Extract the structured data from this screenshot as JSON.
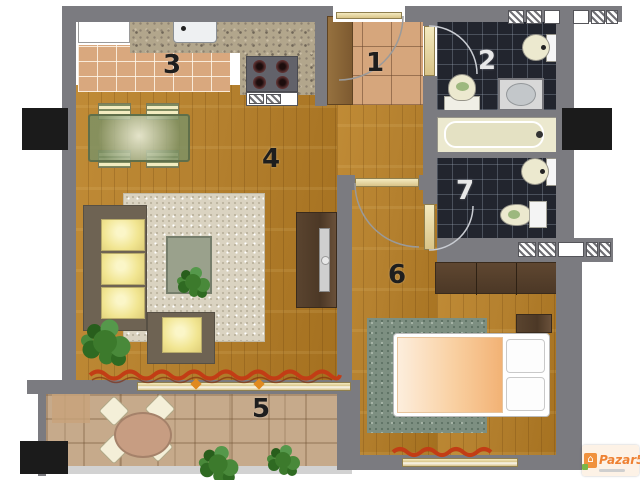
{
  "rooms": {
    "entry": "1",
    "main_bath": "2",
    "kitchen": "3",
    "living_room": "4",
    "terrace": "5",
    "bedroom": "6",
    "ensuite_bath": "7"
  },
  "watermark": {
    "brand": "Pazar5",
    "suffix": ".mk"
  },
  "icons": {
    "watermark_house": "⌂"
  },
  "colors": {
    "wall_gray": "#7b7b80",
    "wood_floor": "#b5812f",
    "warm_tile": "#d9a87e",
    "dark_tile": "#22252e",
    "fixture_cream": "#ece9cf",
    "curtain_red": "#c23d15",
    "brand_orange": "#ee8132",
    "brand_green": "#7ab648"
  }
}
